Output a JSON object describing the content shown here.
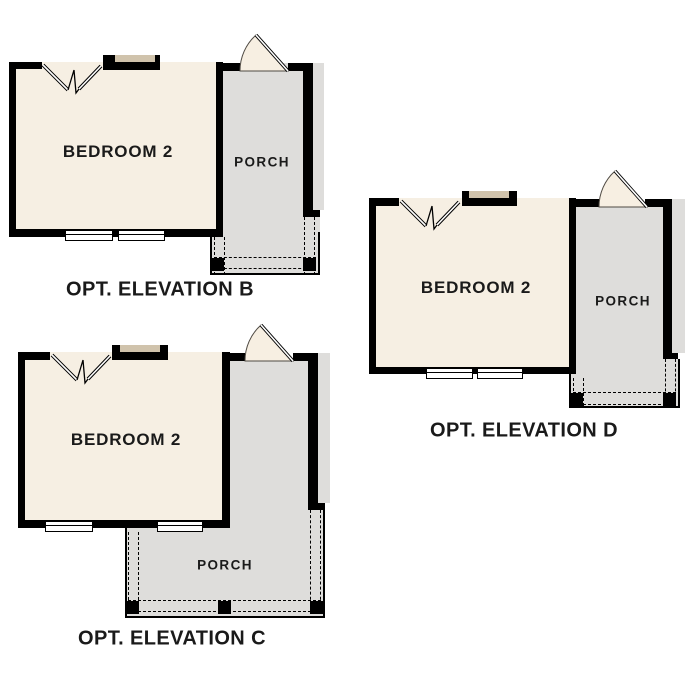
{
  "colors": {
    "background": "#ffffff",
    "wall": "#000000",
    "room_fill": "#f6efe3",
    "porch_fill": "#dedddb",
    "accent_tan": "#d0c3ac",
    "door_fill": "#f7efe2",
    "text": "#1a1a1a"
  },
  "plans": [
    {
      "name": "Opt. Elevation B",
      "room_label": "BEDROOM 2",
      "porch_label": "PORCH",
      "caption": "OPT. ELEVATION B"
    },
    {
      "name": "Opt. Elevation C",
      "room_label": "BEDROOM 2",
      "porch_label": "PORCH",
      "caption": "OPT. ELEVATION C"
    },
    {
      "name": "Opt. Elevation D",
      "room_label": "BEDROOM 2",
      "porch_label": "PORCH",
      "caption": "OPT. ELEVATION D"
    }
  ]
}
